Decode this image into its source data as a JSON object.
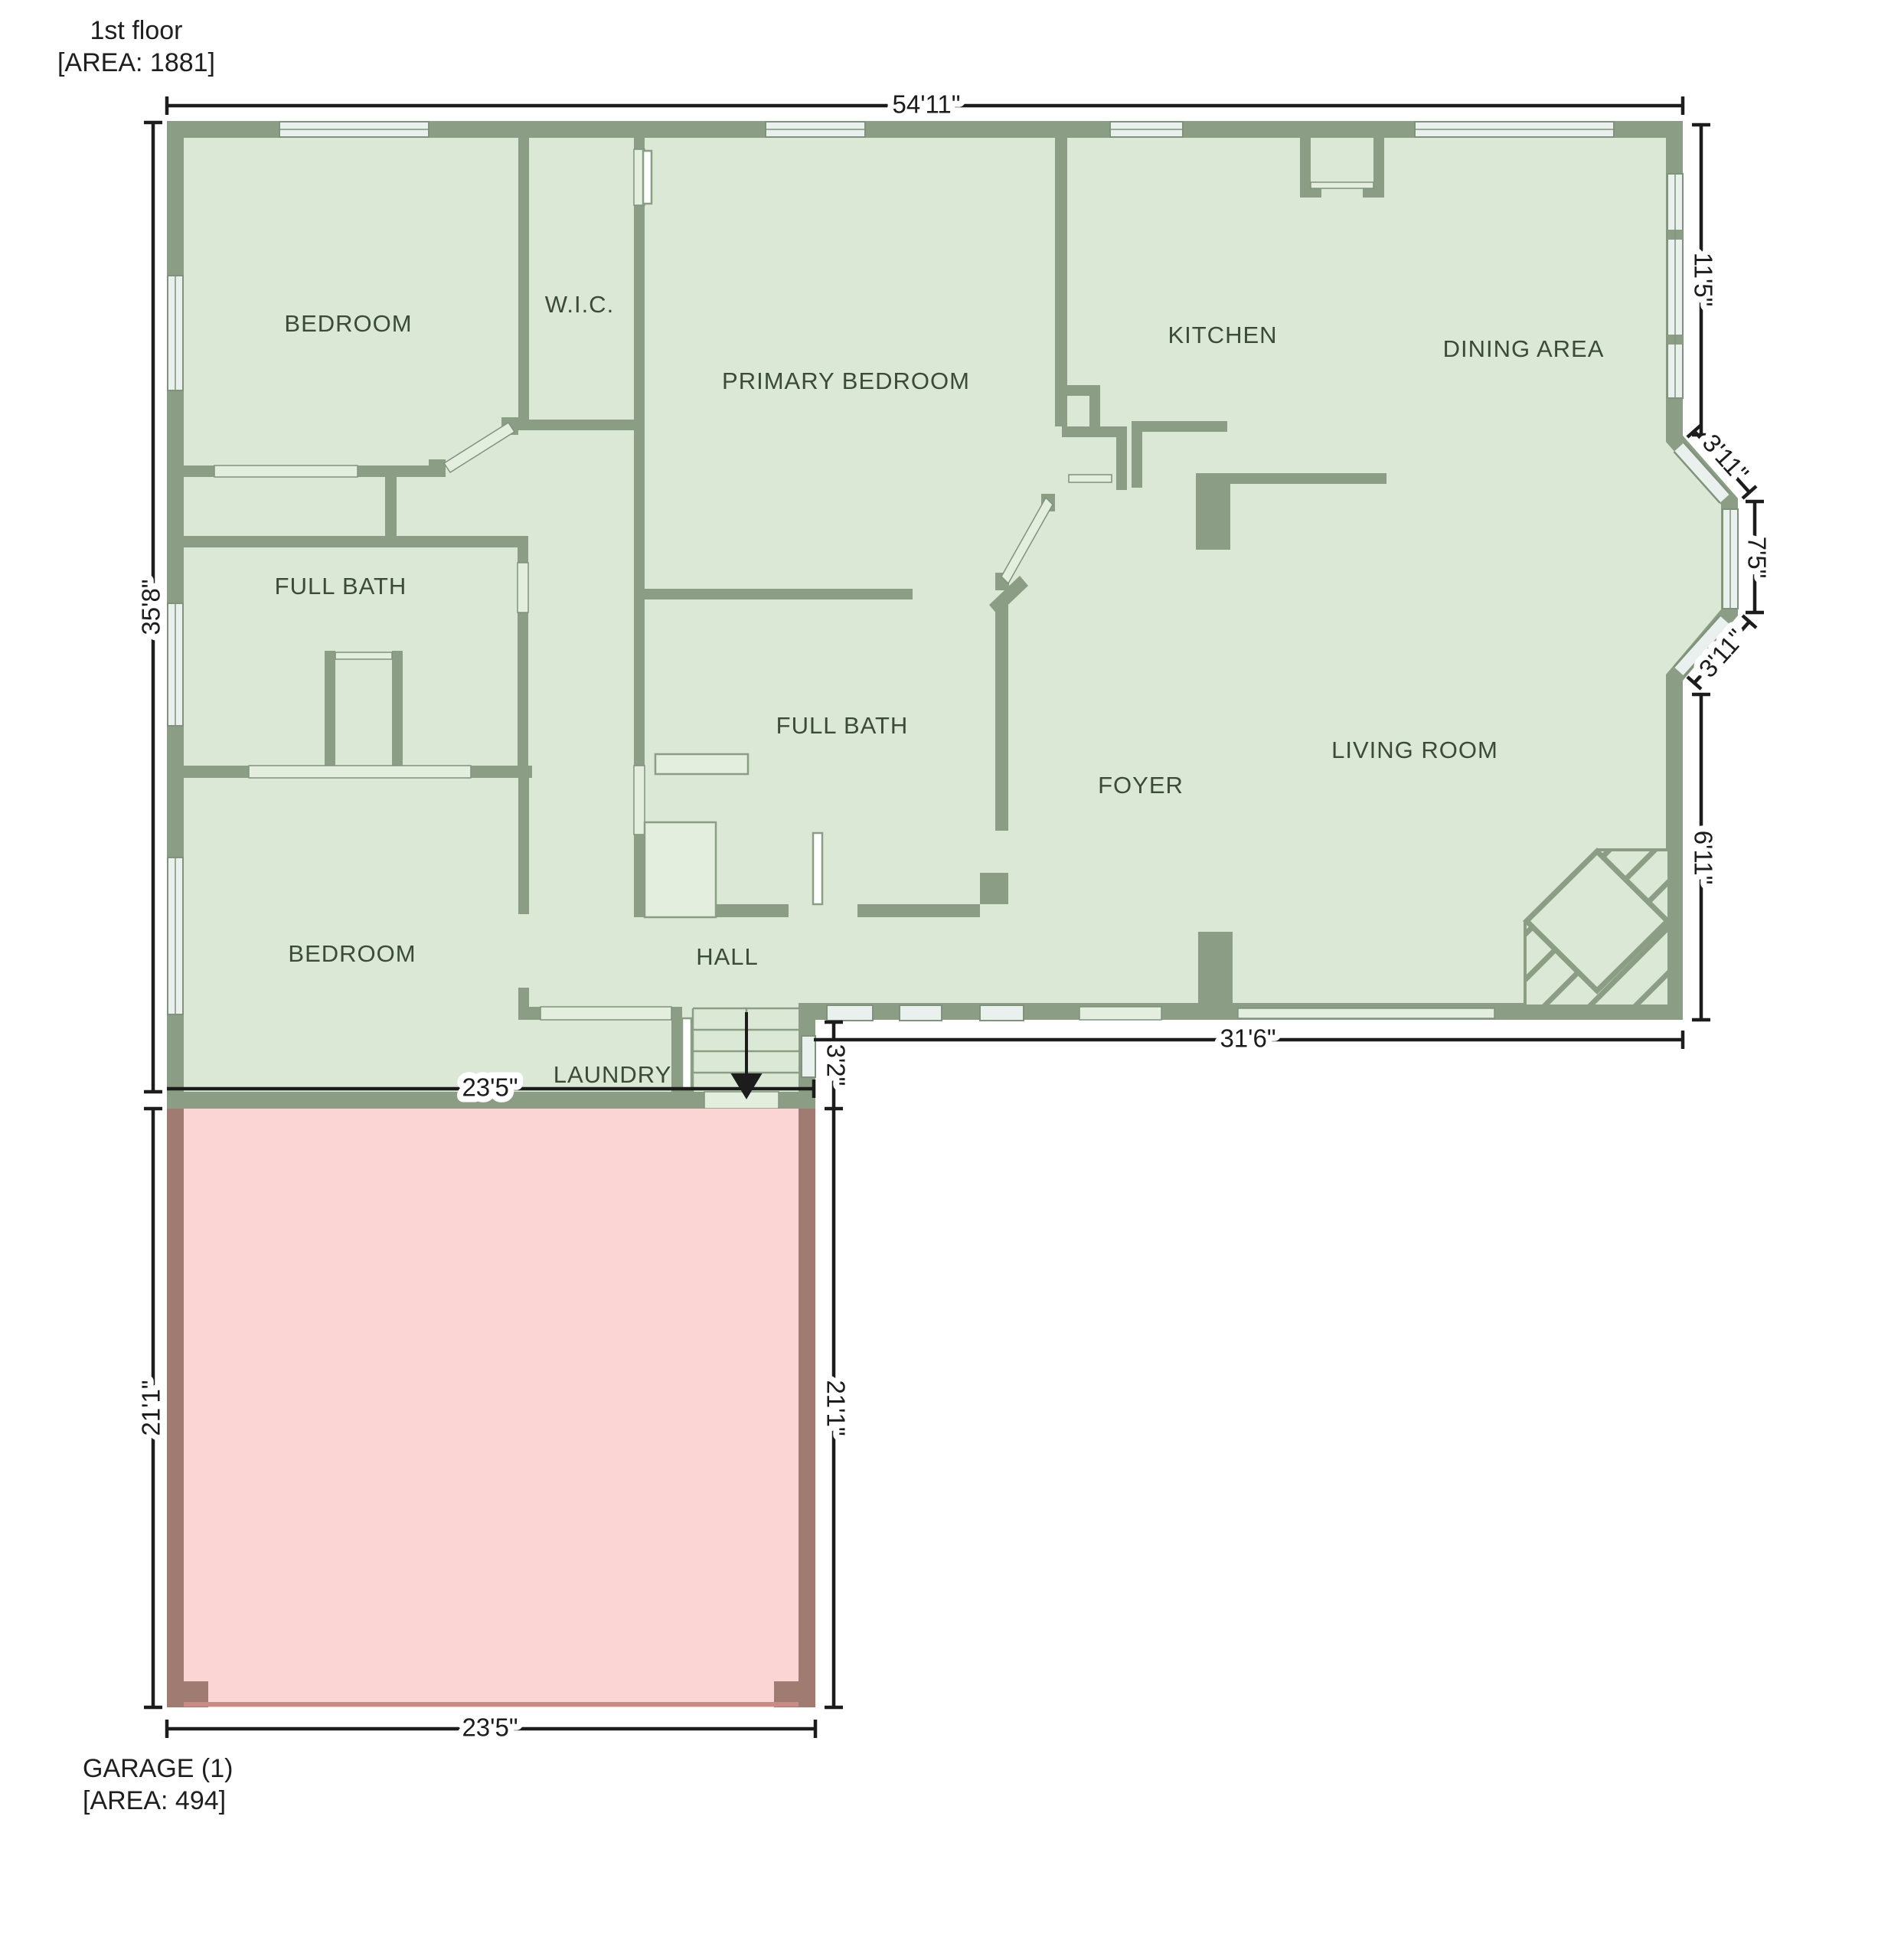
{
  "floor_plan": {
    "floor_label": {
      "title": "1st floor",
      "area": "[AREA: 1881]"
    },
    "garage_label": {
      "title": "GARAGE (1)",
      "area": "[AREA: 494]"
    },
    "rooms": {
      "bedroom_top": "BEDROOM",
      "wic": "W.I.C.",
      "primary_bedroom": "PRIMARY BEDROOM",
      "kitchen": "KITCHEN",
      "dining_area": "DINING AREA",
      "full_bath_left": "FULL BATH",
      "full_bath_center": "FULL BATH",
      "foyer": "FOYER",
      "living_room": "LIVING ROOM",
      "bedroom_bottom": "BEDROOM",
      "hall": "HALL",
      "laundry": "LAUNDRY"
    },
    "dimensions": {
      "overall_width": "54'11\"",
      "overall_height_left": "35'8\"",
      "right_top": "11'5\"",
      "bay_top_angled": "3'11\"",
      "bay_middle": "7'5\"",
      "bay_bottom_angled": "3'11\"",
      "right_bottom": "6'11\"",
      "living_bottom_width": "31'6\"",
      "step_offset": "3'2\"",
      "garage_width_top": "23'5\"",
      "garage_width_bottom": "23'5\"",
      "garage_height_left": "21'1\"",
      "garage_height_right": "21'1\""
    },
    "colors": {
      "floor-fill": "#dbe8d5",
      "wall": "#8b9d84",
      "garage-fill": "#fbd5d3",
      "garage-wall": "#a07b72",
      "garage-door-line": "#c98b85",
      "window-fill": "#e9f0ee",
      "window-frame": "#7f937c",
      "opening-fill": "#e4eedf",
      "dim": "#1c1c1c",
      "room-label": "#3a4b36"
    }
  }
}
